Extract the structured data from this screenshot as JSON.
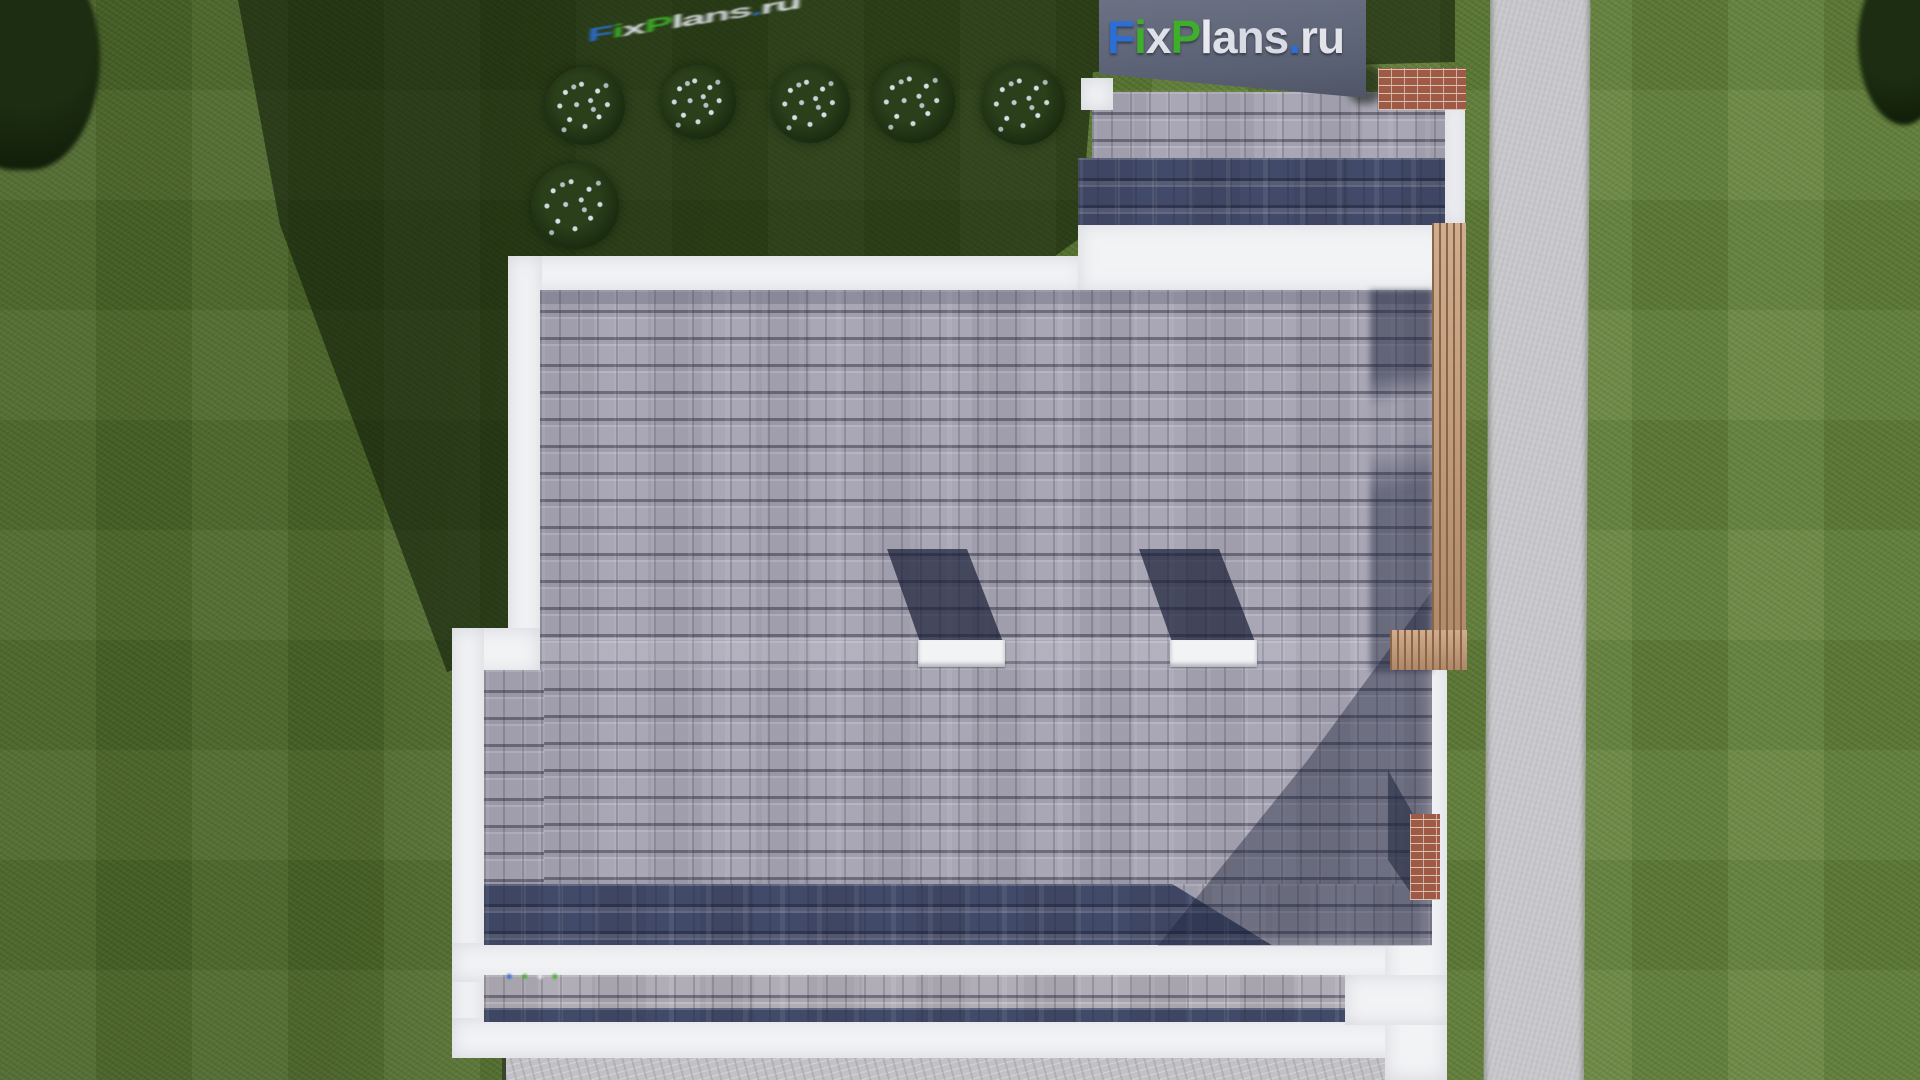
{
  "watermark": {
    "text": "FixPlans.ru",
    "letters": [
      {
        "ch": "F",
        "color": "#2b6fd6"
      },
      {
        "ch": "i",
        "color": "#3fae2a"
      },
      {
        "ch": "x",
        "color": "#dfe1e8"
      },
      {
        "ch": "P",
        "color": "#3fae2a"
      },
      {
        "ch": "l",
        "color": "#e8eaef"
      },
      {
        "ch": "a",
        "color": "#dfe1e8"
      },
      {
        "ch": "n",
        "color": "#d8dbe3"
      },
      {
        "ch": "s",
        "color": "#d8dbe3"
      },
      {
        "ch": ".",
        "color": "#2b6fd6"
      },
      {
        "ch": "r",
        "color": "#e2e4ea"
      },
      {
        "ch": "u",
        "color": "#e2e4ea"
      }
    ]
  },
  "palette": {
    "grass_lit": "#5c7c33",
    "grass_shadow": "#223317",
    "roof_light": "#a9a7b5",
    "roof_dark": "#414a68",
    "fascia_white": "#f2f3f5",
    "path_gray": "#c8c8cc",
    "patio_gray": "#c2c2c6",
    "wood": "#c69b76",
    "wood_line": "#8a6548",
    "brick": "#9e5a45",
    "brick_mortar": "#d8c2b4",
    "banner_bg": "#636c7e"
  }
}
